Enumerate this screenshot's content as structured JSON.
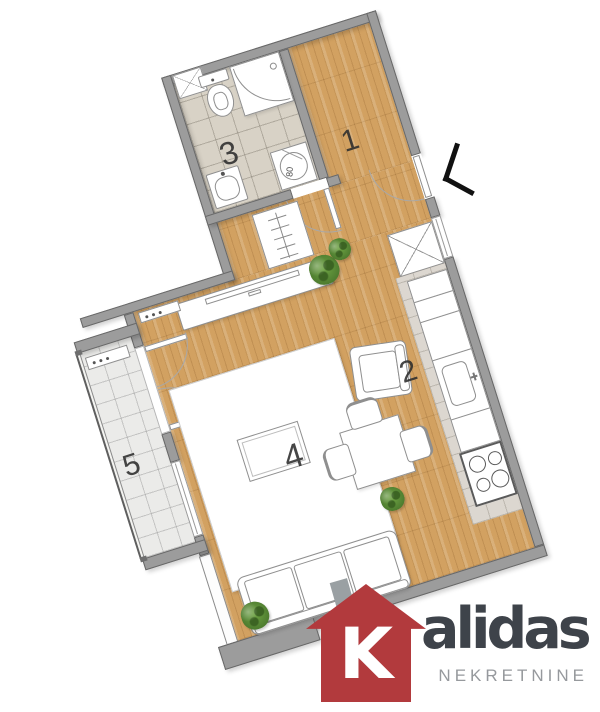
{
  "plan": {
    "rooms": [
      {
        "id": "hallway",
        "number": "1"
      },
      {
        "id": "kitchen",
        "number": "2"
      },
      {
        "id": "bathroom",
        "number": "3"
      },
      {
        "id": "living-room",
        "number": "4"
      },
      {
        "id": "balcony",
        "number": "5"
      }
    ],
    "appliances": {
      "washing_machine_label": "80"
    },
    "fixtures": [
      "toilet",
      "corner-shower",
      "washbasin",
      "washing-machine",
      "bathroom-window",
      "hall-wardrobe",
      "tall-cabinet",
      "fridge",
      "kitchen-cabinet",
      "kitchen-sink",
      "stove",
      "dining-table",
      "chairs",
      "sofa",
      "armchair",
      "coffee-table",
      "rug",
      "tv-stand",
      "radiators",
      "plants",
      "entrance-chevron",
      "glass-railing",
      "french-doors",
      "windows"
    ]
  },
  "branding": {
    "logo_initial": "K",
    "logo_name_rest": "alidas",
    "logo_subtitle": "NEKRETNINE",
    "house_color": "#b23a3d",
    "chimney_color": "#9aa0a3",
    "text_color": "#3e434a",
    "subtitle_color": "#96999d"
  },
  "palette": {
    "wall": "#9c9c9c",
    "wall_border": "#686868",
    "wood_floor": "#d2a161",
    "bathroom_tile": "#d8d2c6",
    "balcony_tile": "#ebebe9",
    "kitchen_tile": "#dcd7d0",
    "furniture_fill": "#ffffff",
    "furniture_stroke": "#8f8f8f"
  }
}
